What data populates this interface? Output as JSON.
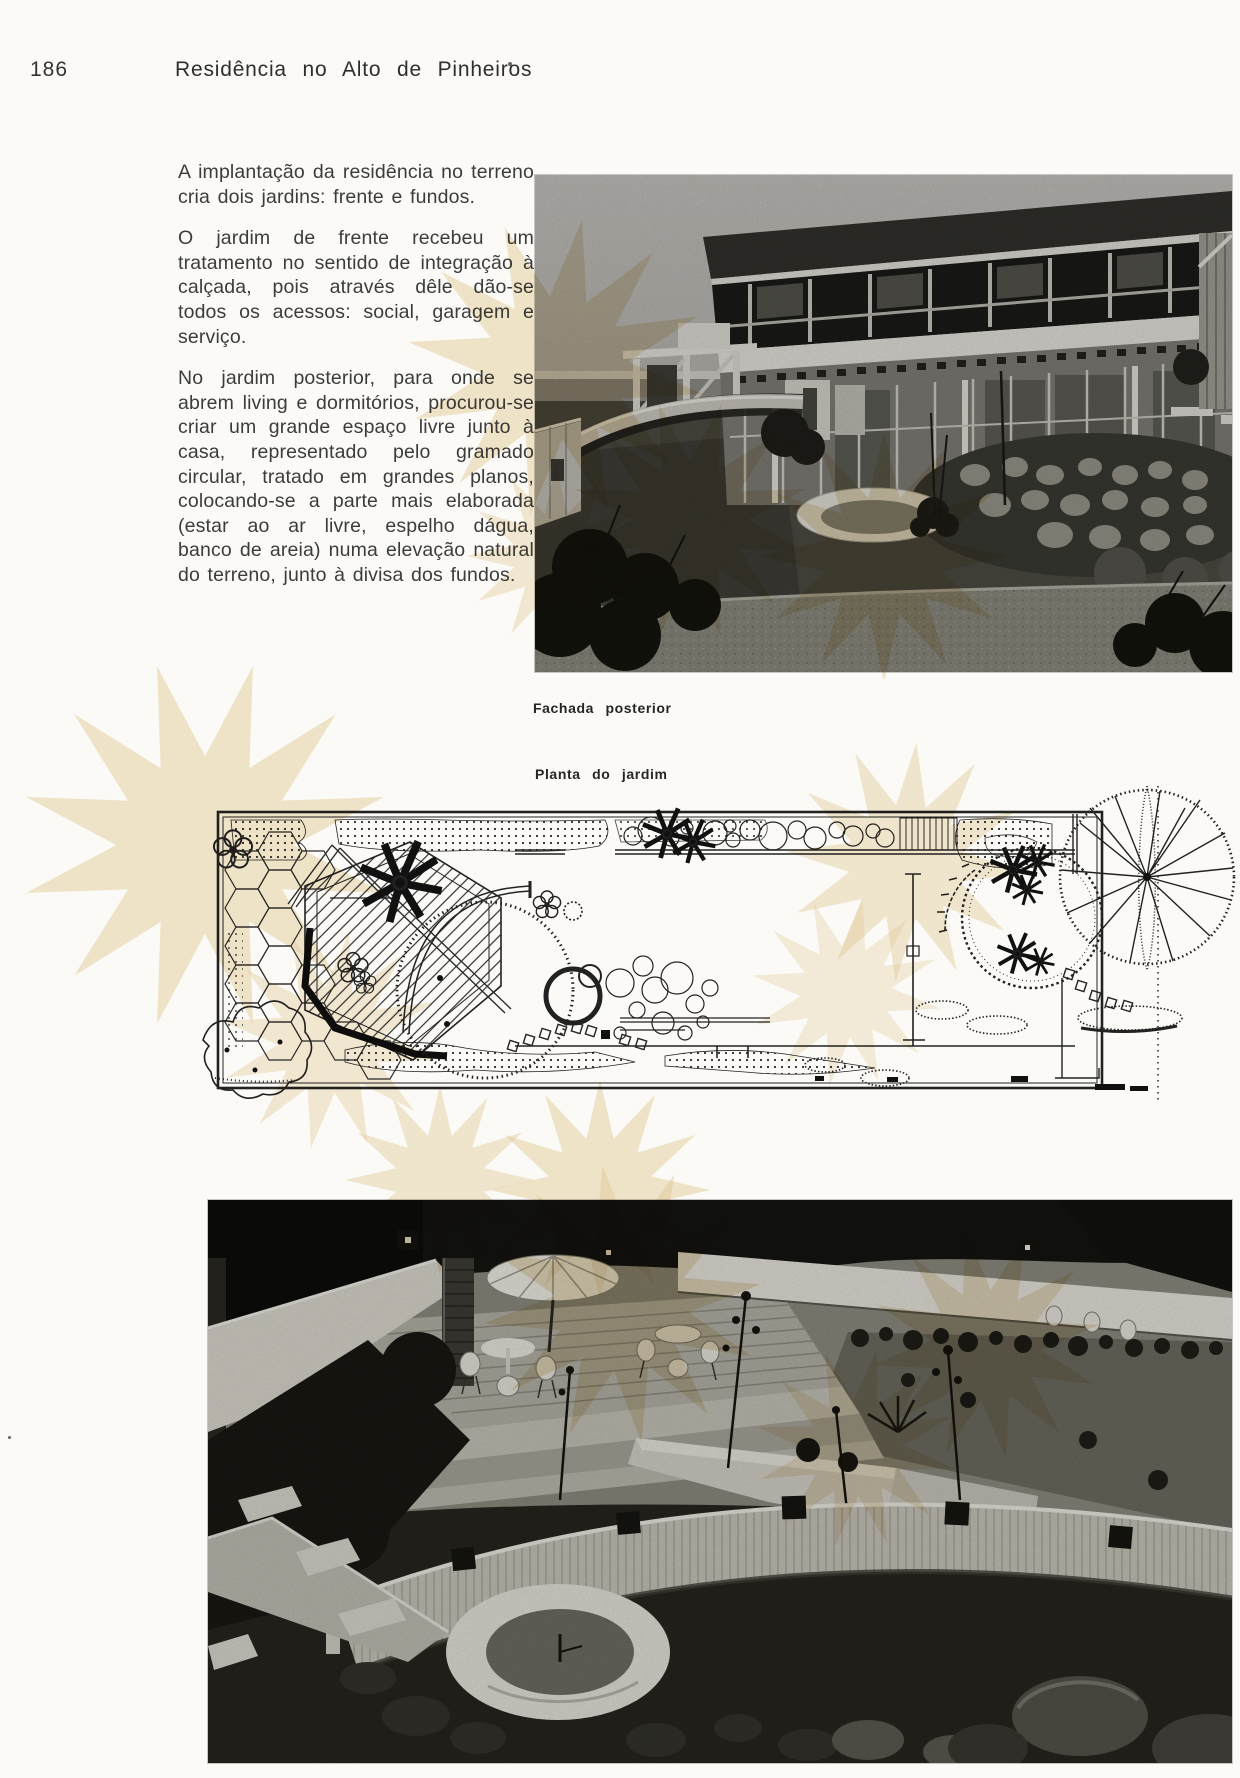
{
  "page": {
    "number": "186",
    "title": "Residência no Alto de Pinheiros"
  },
  "article": {
    "paragraphs": [
      "A implantação da residência no terreno cria dois jardins: frente e fundos.",
      "O jardim de frente recebeu um tratamento no sentido de integração à calçada, pois através dêle dão-se todos os acessos: social, garagem e serviço.",
      "No jardim posterior, para onde se abrem living e dormitórios, procurou-se criar um grande espaço livre junto à casa, representado pelo gramado circular, tratado em grandes planos, colocando-se a parte mais elaborada (estar ao ar livre, espelho dágua, banco de areia) numa elevação natural do terreno, junto à divisa dos fundos."
    ]
  },
  "figures": {
    "facade_caption": "Fachada posterior",
    "plan_caption": "Planta do jardim"
  },
  "colors": {
    "paper": "#fbfaf6",
    "ink": "#3c3c3c",
    "watermark": "#e5cfa0"
  }
}
